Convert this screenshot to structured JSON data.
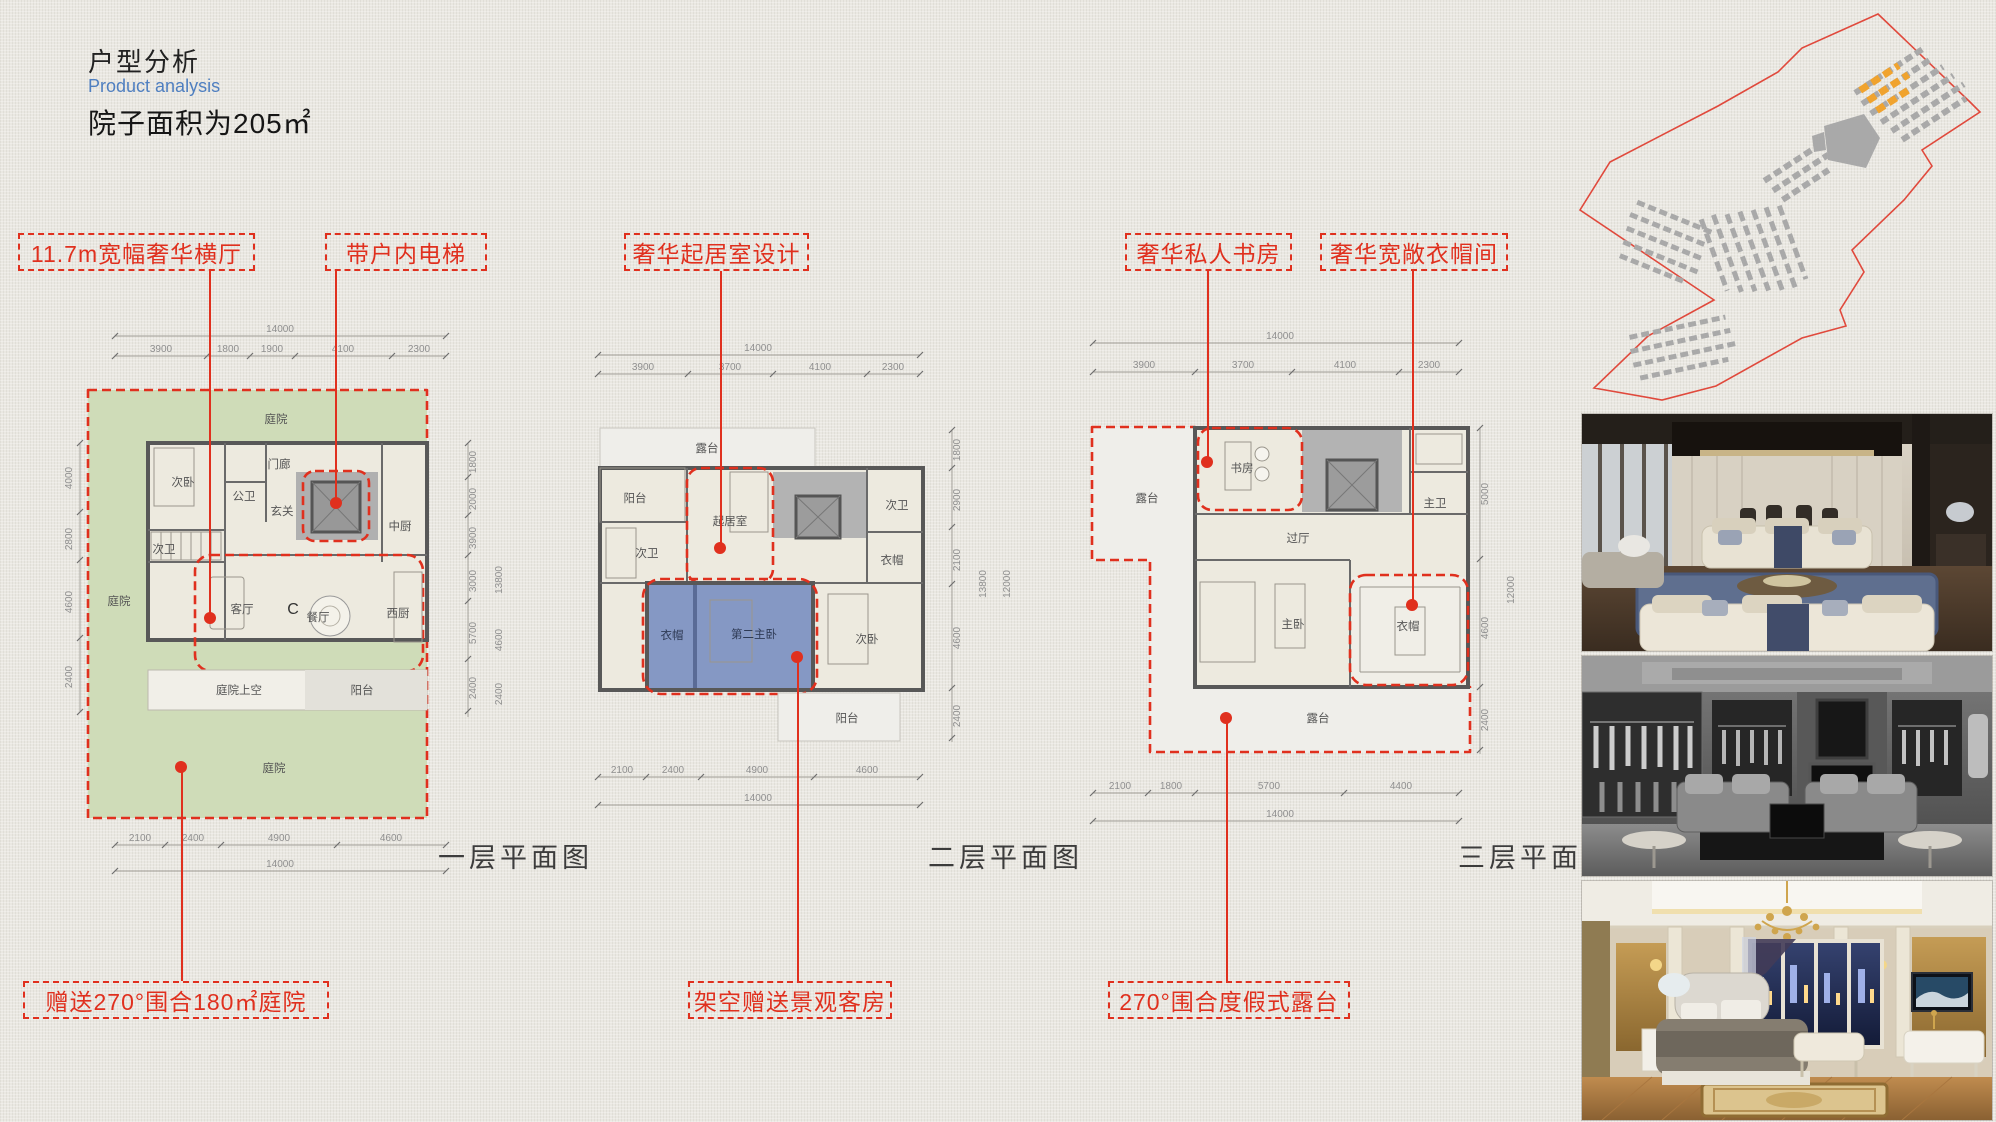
{
  "header": {
    "title_cn": "户型分析",
    "title_en": "Product analysis",
    "subtitle": "院子面积为205㎡"
  },
  "colors": {
    "callout_red": "#e0301e",
    "courtyard_green": "#cfdcb8",
    "highlight_blue": "#8598c4",
    "accent_blue": "#4f7fc0",
    "site_orange": "#f0a32e"
  },
  "callouts": {
    "top": [
      "11.7m宽幅奢华横厅",
      "带户内电梯",
      "奢华起居室设计",
      "奢华私人书房",
      "奢华宽敞衣帽间"
    ],
    "bottom": [
      "赠送270°围合180㎡庭院",
      "架空赠送景观客房",
      "270°围合度假式露台"
    ]
  },
  "plans": [
    {
      "caption": "一层平面图",
      "dims": {
        "top_total": "14000",
        "top": [
          "3900",
          "1800",
          "1900",
          "4100",
          "2300"
        ],
        "bottom": [
          "2100",
          "2400",
          "4900",
          "4600"
        ],
        "bottom_total": "14000",
        "left": [
          "4000",
          "2800",
          "4600",
          "2400"
        ],
        "right": [
          "1800",
          "2000",
          "3900",
          "3000",
          "5700",
          "2400"
        ],
        "right_outer": [
          "13800",
          "4600",
          "2400"
        ]
      },
      "rooms": {
        "courtyard_top": "庭院",
        "courtyard_left": "庭院",
        "courtyard_bottom": "庭院",
        "porch": "门廊",
        "bedroom": "次卧",
        "public_bath": "公卫",
        "foyer": "玄关",
        "kitchen_cn": "中厨",
        "bath": "次卫",
        "living": "客厅",
        "unit": "C",
        "dining": "餐厅",
        "kitchen_w": "西厨",
        "court_void": "庭院上空",
        "balcony": "阳台"
      }
    },
    {
      "caption": "二层平面图",
      "dims": {
        "top_total": "14000",
        "top": [
          "3900",
          "3700",
          "4100",
          "2300"
        ],
        "bottom": [
          "2100",
          "2400",
          "4900",
          "4600"
        ],
        "bottom_total": "14000",
        "right": [
          "1800",
          "2900",
          "2100",
          "4600",
          "2400"
        ],
        "right_outer": [
          "13800",
          "12000"
        ]
      },
      "rooms": {
        "terrace": "露台",
        "balcony_left": "阳台",
        "bath_left": "次卫",
        "living": "起居室",
        "bath_right": "次卫",
        "cloak_right": "衣帽",
        "cloak_blue": "衣帽",
        "master2": "第二主卧",
        "bedroom": "次卧",
        "balcony_bottom": "阳台"
      }
    },
    {
      "caption": "三层平面图",
      "dims": {
        "top_total": "14000",
        "top": [
          "3900",
          "3700",
          "4100",
          "2300"
        ],
        "bottom": [
          "2100",
          "1800",
          "5700",
          "4400"
        ],
        "bottom_total": "14000",
        "right": [
          "5000",
          "4600",
          "2400"
        ],
        "right_outer": [
          "12000"
        ]
      },
      "rooms": {
        "terrace_left": "露台",
        "study": "书房",
        "master_bath": "主卫",
        "hall": "过厅",
        "master": "主卧",
        "cloak": "衣帽",
        "terrace_bottom": "露台"
      }
    }
  ]
}
